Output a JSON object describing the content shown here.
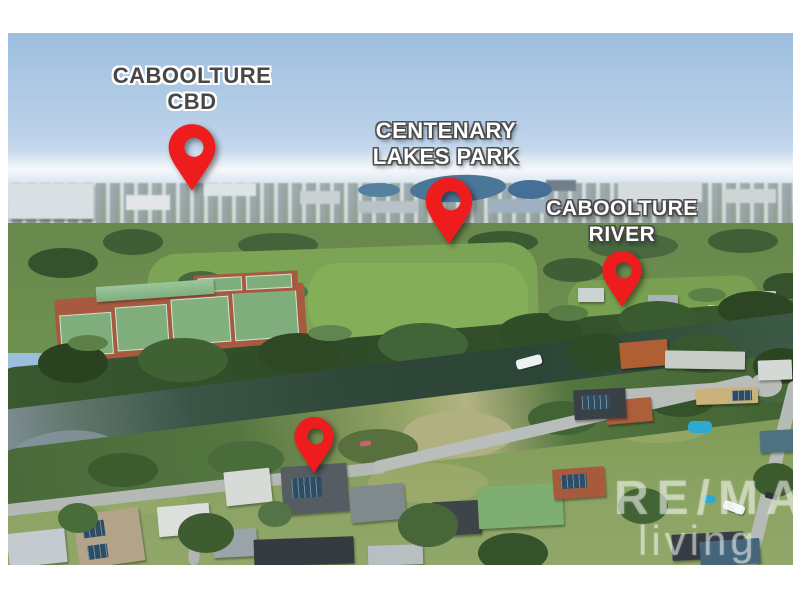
{
  "markers": [
    {
      "id": "caboolture-cbd",
      "lines": [
        "CABOOLTURE",
        "CBD"
      ],
      "text_style": "dark-text-white-outline"
    },
    {
      "id": "centenary-lakes-park",
      "lines": [
        "CENTENARY",
        "LAKES PARK"
      ],
      "text_style": "white-text-dark-outline"
    },
    {
      "id": "caboolture-river",
      "lines": [
        "CABOOLTURE",
        "RIVER"
      ],
      "text_style": "white-text-dark-outline"
    },
    {
      "id": "subject-property",
      "lines": [],
      "text_style": "none"
    }
  ],
  "watermark": {
    "line1": "RE/MAX",
    "line2": "living"
  },
  "colors": {
    "pin_red": "#ee1c1c",
    "label_dark_text": "#474747",
    "label_light_text": "#ffffff",
    "sky_top": "#9cbede",
    "horizon_haze": "#e8edf1",
    "park_green": "#7ca455",
    "tree_dark_green": "#2f4a27",
    "river_water": "#2e4739",
    "tennis_court_green": "#7fae7c",
    "tennis_clay": "#a85a40",
    "road_gray": "#b7bbb7",
    "watermark_white": "#ffffff"
  }
}
